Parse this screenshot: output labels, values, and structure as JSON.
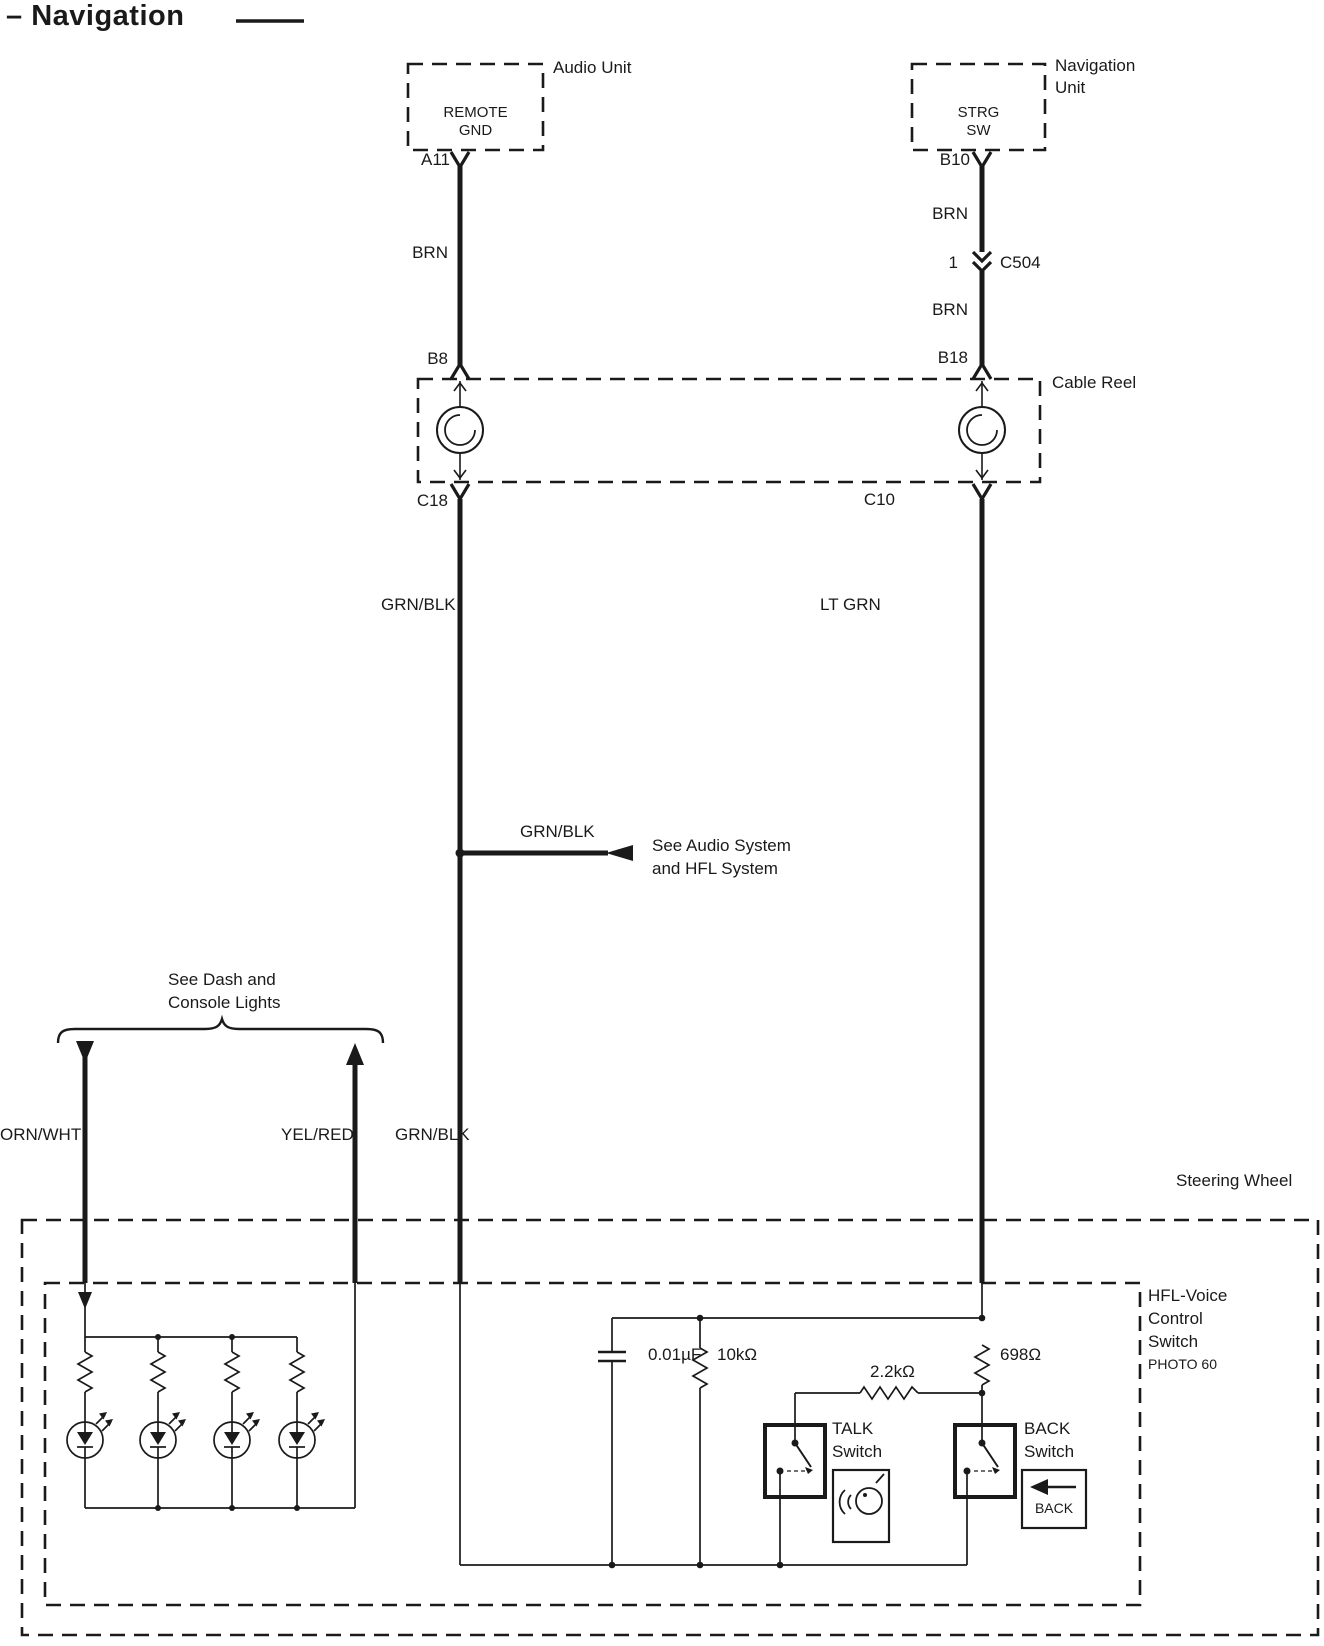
{
  "header": {
    "dash": "–",
    "title": "Navigation"
  },
  "audio_unit": {
    "name": "Audio Unit",
    "terminal_line1": "REMOTE",
    "terminal_line2": "GND",
    "pin": "A11"
  },
  "navigation_unit": {
    "name_line1": "Navigation",
    "name_line2": "Unit",
    "terminal_line1": "STRG",
    "terminal_line2": "SW",
    "pin": "B10"
  },
  "cable_reel": {
    "name": "Cable Reel",
    "pin_top_left": "B8",
    "pin_top_right": "B18",
    "pin_bottom_left": "C18",
    "pin_bottom_right": "C10"
  },
  "inline_connector": {
    "cavity": "1",
    "name": "C504"
  },
  "wire_labels": {
    "brn_left": "BRN",
    "brn_upper_right": "BRN",
    "brn_lower_right": "BRN",
    "grnblk_upper": "GRN/BLK",
    "ltgrn": "LT GRN",
    "grnblk_branch": "GRN/BLK",
    "ornwht": "ORN/WHT",
    "yelred": "YEL/RED",
    "grnblk_lower": "GRN/BLK"
  },
  "references": {
    "audio_line1": "See Audio System",
    "audio_line2": "and HFL System",
    "dash_line1": "See Dash and",
    "dash_line2": "Console Lights"
  },
  "steering_wheel": {
    "name": "Steering Wheel"
  },
  "hfl_switch": {
    "name_line1": "HFL-Voice",
    "name_line2": "Control",
    "name_line3": "Switch",
    "photo": "PHOTO 60",
    "capacitor": "0.01µF",
    "resistor_pullup": "10kΩ",
    "resistor_talk": "2.2kΩ",
    "resistor_back": "698Ω",
    "talk_line1": "TALK",
    "talk_line2": "Switch",
    "back_line1": "BACK",
    "back_line2": "Switch",
    "back_button": "BACK"
  }
}
